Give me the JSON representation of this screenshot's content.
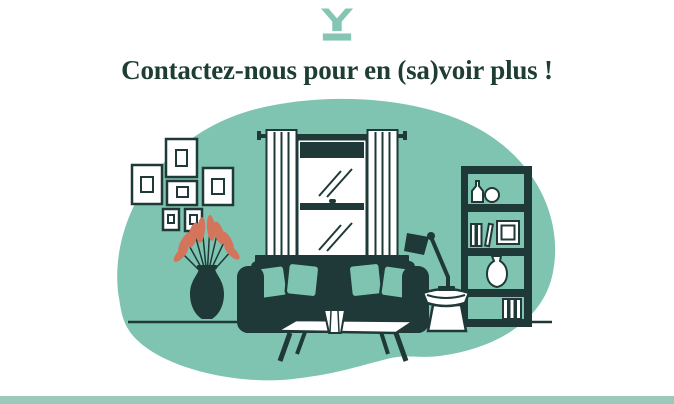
{
  "header": {
    "logo_icon": "brand-mark-icon",
    "title": "Contactez-nous pour en (sa)voir plus !"
  },
  "colors": {
    "background": "#ffffff",
    "teal_blob": "#7fc4b1",
    "ink_dark": "#1e3937",
    "heading_text": "#1e3d33",
    "plant_coral": "#d3745b",
    "footer_bar": "#9dc8bc",
    "logo_teal": "#85c5b3"
  },
  "illustration": {
    "scene": "living-room",
    "elements": [
      "picture-frames",
      "plant-vase",
      "window-with-curtains",
      "sofa-with-cushions",
      "coffee-table",
      "desk-lamp",
      "side-table",
      "bookshelf"
    ]
  }
}
